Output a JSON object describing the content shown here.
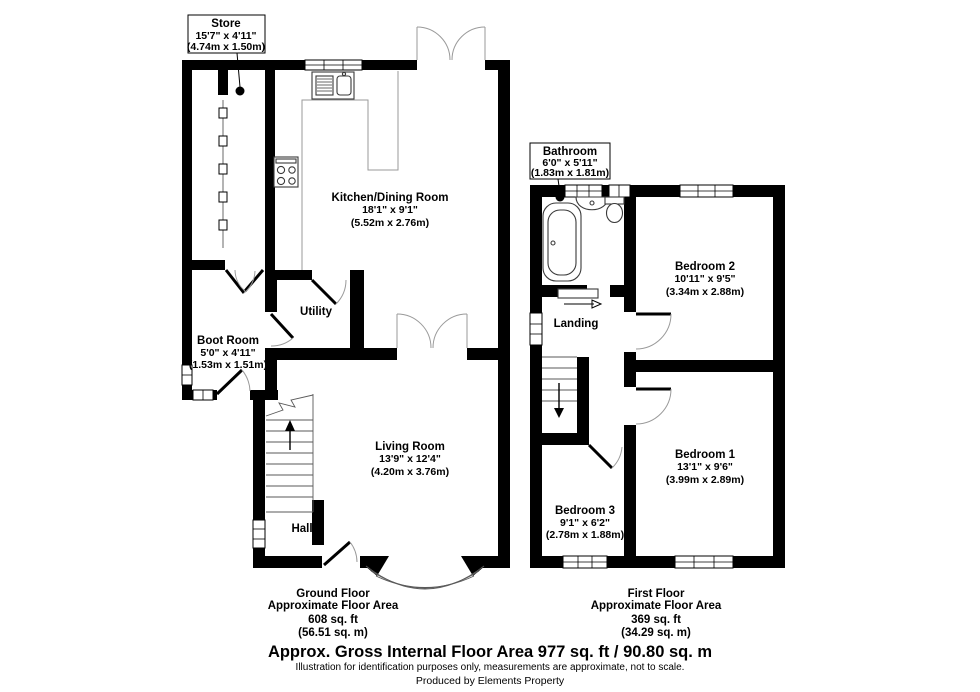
{
  "ground_floor": {
    "store": {
      "name": "Store",
      "dims": "15'7\" x 4'11\"",
      "metric": "(4.74m x 1.50m)"
    },
    "kitchen": {
      "name": "Kitchen/Dining Room",
      "dims": "18'1\" x 9'1\"",
      "metric": "(5.52m x 2.76m)"
    },
    "utility": {
      "name": "Utility"
    },
    "boot_room": {
      "name": "Boot Room",
      "dims": "5'0\" x 4'11\"",
      "metric": "(1.53m x 1.51m)"
    },
    "living_room": {
      "name": "Living Room",
      "dims": "13'9\" x 12'4\"",
      "metric": "(4.20m x 3.76m)"
    },
    "hall": {
      "name": "Hall"
    },
    "summary": {
      "title": "Ground Floor",
      "subtitle": "Approximate Floor Area",
      "area_ft": "608 sq. ft",
      "area_m": "(56.51 sq. m)"
    }
  },
  "first_floor": {
    "bathroom": {
      "name": "Bathroom",
      "dims": "6'0\" x 5'11\"",
      "metric": "(1.83m x 1.81m)"
    },
    "bedroom2": {
      "name": "Bedroom 2",
      "dims": "10'11\" x 9'5\"",
      "metric": "(3.34m x 2.88m)"
    },
    "landing": {
      "name": "Landing"
    },
    "bedroom1": {
      "name": "Bedroom 1",
      "dims": "13'1\" x 9'6\"",
      "metric": "(3.99m x 2.89m)"
    },
    "bedroom3": {
      "name": "Bedroom 3",
      "dims": "9'1\" x 6'2\"",
      "metric": "(2.78m x 1.88m)"
    },
    "summary": {
      "title": "First Floor",
      "subtitle": "Approximate Floor Area",
      "area_ft": "369 sq. ft",
      "area_m": "(34.29 sq. m)"
    }
  },
  "footer": {
    "gross": "Approx. Gross Internal Floor Area 977 sq. ft / 90.80 sq. m",
    "disclaimer": "Illustration for identification purposes only, measurements are approximate, not to scale.",
    "credit": "Produced by Elements Property"
  },
  "colors": {
    "wall": "#000000",
    "door_arc": "#9a9a9a",
    "background": "#ffffff"
  }
}
